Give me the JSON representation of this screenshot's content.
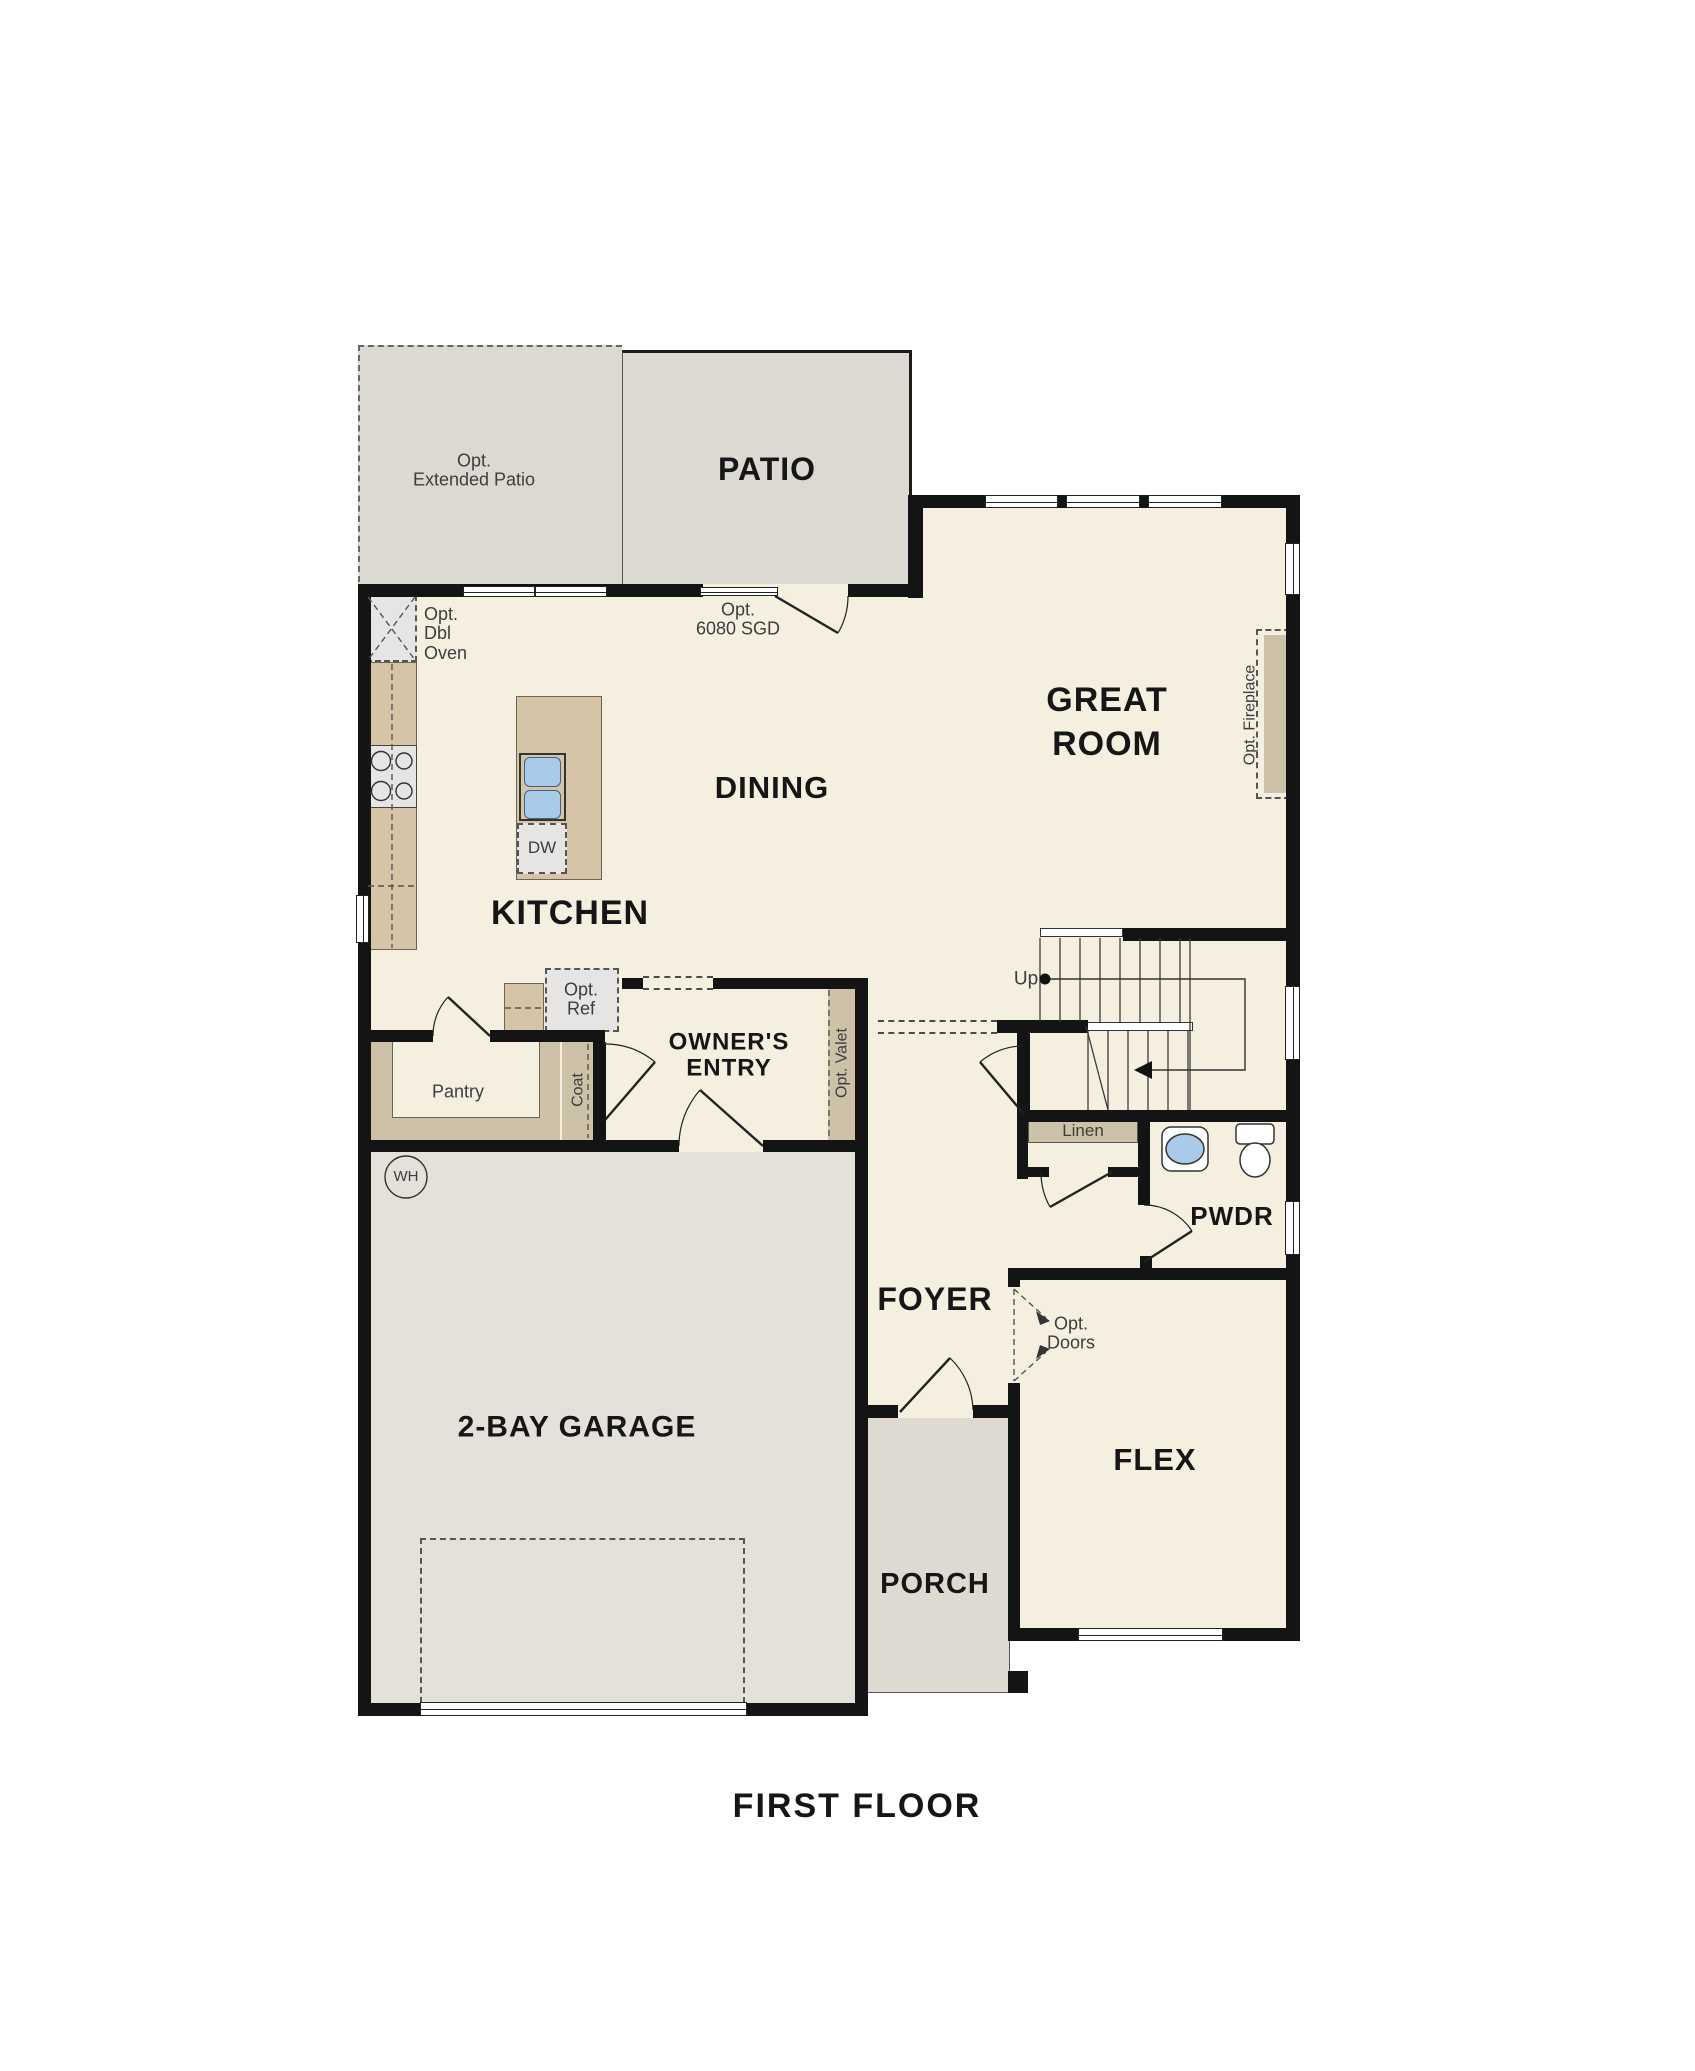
{
  "title": "FIRST FLOOR",
  "labels": {
    "patio": "PATIO",
    "great_room": [
      "GREAT",
      "ROOM"
    ],
    "dining": "DINING",
    "kitchen": "KITCHEN",
    "owners_entry": [
      "OWNER'S",
      "ENTRY"
    ],
    "foyer": "FOYER",
    "garage": "2-BAY GARAGE",
    "flex": "FLEX",
    "porch": "PORCH",
    "pwdr": "PWDR",
    "pantry": "Pantry",
    "first_floor": "FIRST FLOOR"
  },
  "annotations": {
    "extended_patio": [
      "Opt.",
      "Extended Patio"
    ],
    "sgd": [
      "Opt.",
      "6080 SGD"
    ],
    "dbl_oven": [
      "Opt.",
      "Dbl",
      "Oven"
    ],
    "opt_ref": [
      "Opt.",
      "Ref"
    ],
    "opt_doors": [
      "Opt.",
      "Doors"
    ],
    "opt_valet": "Opt. Valet",
    "opt_fireplace": "Opt. Fireplace",
    "coat": "Coat",
    "linen": "Linen",
    "up": "Up",
    "dw": "DW",
    "wh": "WH"
  },
  "colors": {
    "wall": "#141414",
    "floor": "#f5efe0",
    "patio": "#dcd9d2",
    "garage": "#e4e1db",
    "porch": "#dedad2",
    "counter": "#d5c5a6",
    "trim": "#cdc1a7",
    "appliance": "#e6e5e3",
    "sink": "#a9cae8",
    "line": "#3a3a3a",
    "text_dark": "#161616",
    "text_soft": "#3d3d3d"
  }
}
